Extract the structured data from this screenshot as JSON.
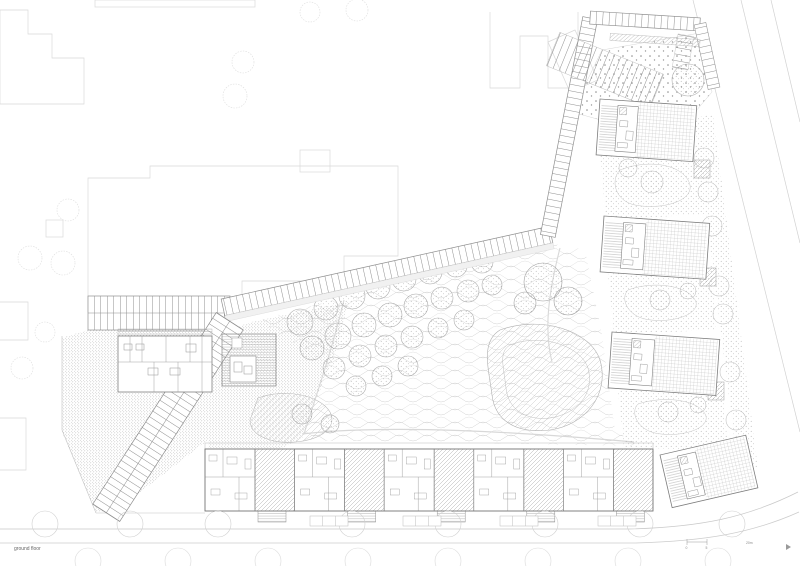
{
  "sheet": {
    "title": "ground floor",
    "scale_bar": {
      "tick_labels": [
        "0",
        "5"
      ],
      "unit_label": "20m"
    }
  },
  "palette": {
    "paper": "#ffffff",
    "context_line": "#d9d9d9",
    "light_line": "#c6c6c6",
    "mid_line": "#9a9a9a",
    "dark_line": "#707070",
    "text": "#666666"
  },
  "drawing": {
    "garden_trees": [
      [
        300,
        322,
        13
      ],
      [
        326,
        308,
        12
      ],
      [
        352,
        296,
        13
      ],
      [
        378,
        287,
        12
      ],
      [
        404,
        279,
        12
      ],
      [
        430,
        272,
        12
      ],
      [
        456,
        266,
        11
      ],
      [
        482,
        262,
        11
      ],
      [
        312,
        348,
        12
      ],
      [
        338,
        336,
        13
      ],
      [
        364,
        325,
        12
      ],
      [
        390,
        315,
        12
      ],
      [
        416,
        306,
        12
      ],
      [
        442,
        298,
        11
      ],
      [
        468,
        291,
        11
      ],
      [
        492,
        285,
        10
      ],
      [
        334,
        368,
        11
      ],
      [
        360,
        356,
        11
      ],
      [
        386,
        346,
        11
      ],
      [
        412,
        337,
        11
      ],
      [
        438,
        328,
        10
      ],
      [
        464,
        320,
        10
      ],
      [
        356,
        386,
        10
      ],
      [
        382,
        376,
        10
      ],
      [
        408,
        366,
        10
      ],
      [
        302,
        414,
        10
      ],
      [
        330,
        424,
        9
      ]
    ],
    "large_trees": [
      [
        543,
        282,
        19
      ],
      [
        568,
        301,
        14
      ],
      [
        525,
        303,
        11
      ]
    ],
    "courtyard_trees": [
      [
        652,
        182,
        11
      ],
      [
        628,
        168,
        9
      ],
      [
        660,
        300,
        10
      ],
      [
        688,
        291,
        8
      ],
      [
        668,
        412,
        10
      ],
      [
        698,
        405,
        8
      ]
    ],
    "roadside_trees": [
      [
        704,
        158,
        10
      ],
      [
        708,
        192,
        10
      ],
      [
        712,
        226,
        10
      ],
      [
        719,
        286,
        10
      ],
      [
        723,
        314,
        10
      ],
      [
        730,
        372,
        10
      ],
      [
        736,
        420,
        10
      ],
      [
        743,
        464,
        9
      ]
    ],
    "context_trees": [
      [
        310,
        12,
        10
      ],
      [
        357,
        10,
        11
      ],
      [
        243,
        62,
        11
      ],
      [
        235,
        96,
        12
      ],
      [
        68,
        210,
        11
      ],
      [
        30,
        258,
        12
      ],
      [
        63,
        263,
        12
      ],
      [
        45,
        332,
        10
      ],
      [
        22,
        368,
        11
      ]
    ],
    "street_trees_row1": [
      45,
      130,
      218,
      352,
      448,
      545,
      640,
      732
    ],
    "street_trees_row2": [
      88,
      178,
      268,
      358,
      448,
      538,
      628,
      718
    ],
    "parking_groups": [
      310,
      403,
      500,
      598
    ],
    "right_buildings": [
      {
        "x": 600,
        "y": 99,
        "w": 97,
        "h": 56,
        "rot": 4
      },
      {
        "x": 604,
        "y": 216,
        "w": 106,
        "h": 56,
        "rot": 4
      },
      {
        "x": 612,
        "y": 332,
        "w": 108,
        "h": 56,
        "rot": 4
      },
      {
        "x": 660,
        "y": 455,
        "w": 88,
        "h": 54,
        "rot": -13
      }
    ],
    "row_houses": {
      "x": 205,
      "y": 449,
      "height": 62,
      "module_white": 50,
      "module_hatch": 39.6,
      "count": 5
    }
  }
}
